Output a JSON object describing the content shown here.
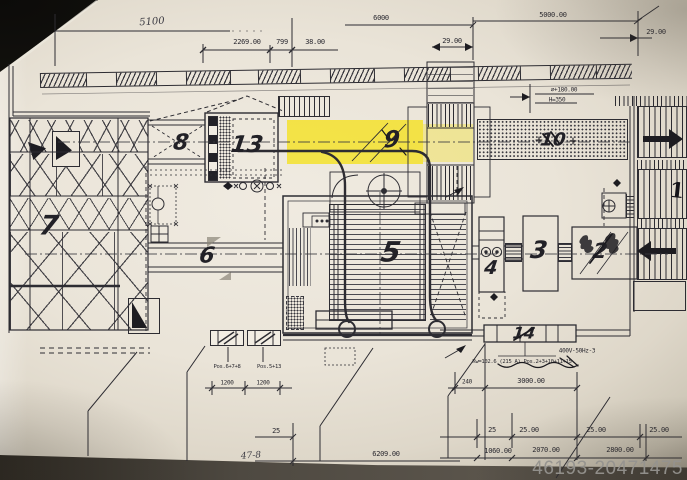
{
  "watermark": "46193-20471475",
  "zones": {
    "z1": "1",
    "z2": "2",
    "z3": "3",
    "z4": "4",
    "z5": "5",
    "z6": "6",
    "z7": "7",
    "z8": "8",
    "z9": "9",
    "z10": "10",
    "z13": "13",
    "z14": "14"
  },
  "dims": {
    "hand_top": "5100",
    "w2269": "2269.00",
    "w799": "799",
    "w38": "38.00",
    "w6000": "6000",
    "w29a": "29.00",
    "w5000": "5000.00",
    "w29b": "29.00",
    "dia": "⌀+180.00",
    "h350": "H=350",
    "volt": "400V-50Hz-3",
    "kw": "Kw=102.6 (215 A) Pos.2+3+10+11+15",
    "pos678": "Pos.6+7+8",
    "pos513": "Pos.5+13",
    "b1200a": "1200",
    "b1200b": "1200",
    "b25a": "25",
    "hand_478": "47-8",
    "b6209": "6209.00",
    "b240": "240",
    "b3000": "3000.00",
    "b25b": "25",
    "b25c": "25.00",
    "b25d": "25.00",
    "b25e": "25.00",
    "b1060": "1060.00",
    "b2070": "2070.00",
    "b2800": "2800.00"
  },
  "colors": {
    "highlight": "#f3e23a",
    "ink": "#2d2c32",
    "paper": "#ebe5da",
    "watermark": "#95938f"
  }
}
